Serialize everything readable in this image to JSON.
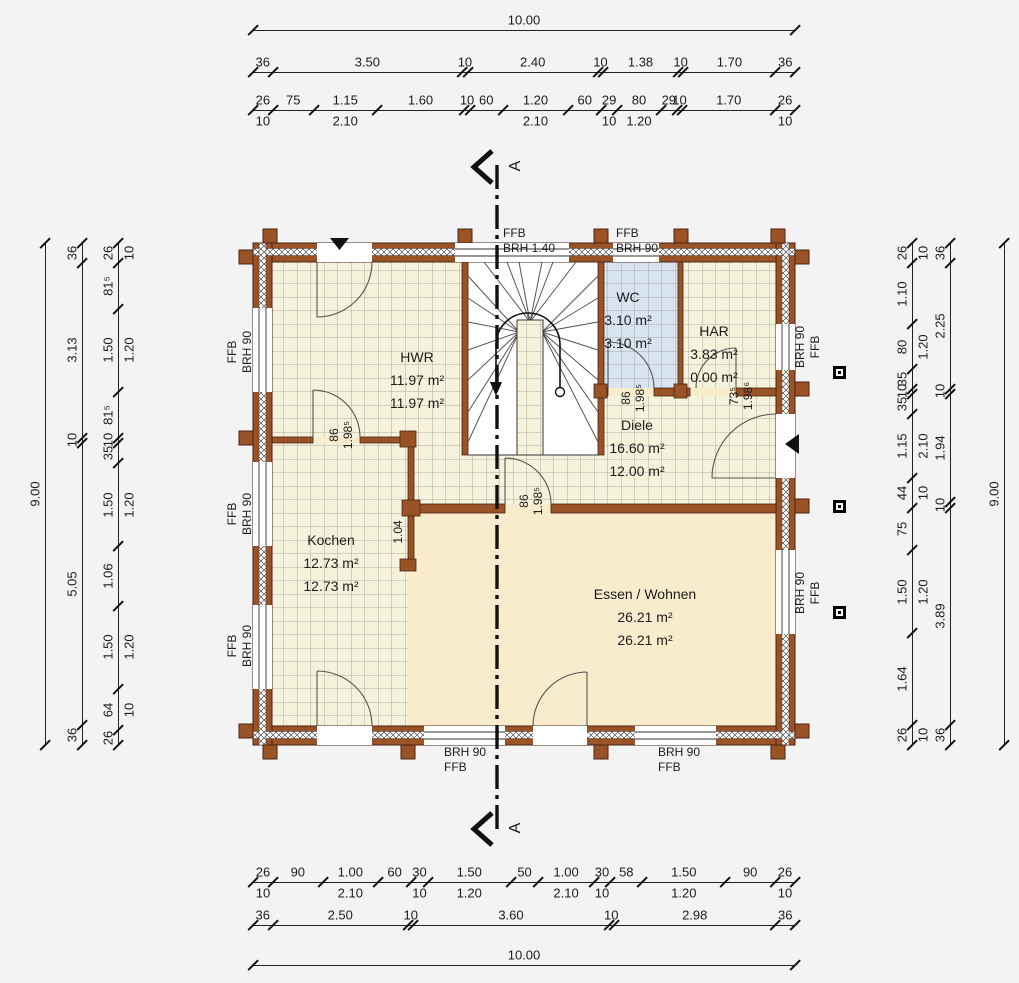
{
  "plan": {
    "section_marker": "A",
    "rooms": [
      {
        "name": "HWR",
        "area1": "11.97 m²",
        "area2": "11.97 m²"
      },
      {
        "name": "WC",
        "area1": "3.10 m²",
        "area2": "3.10 m²"
      },
      {
        "name": "HAR",
        "area1": "3.83 m²",
        "area2": "0.00 m²"
      },
      {
        "name": "Diele",
        "area1": "16.60 m²",
        "area2": "12.00 m²"
      },
      {
        "name": "Kochen",
        "area1": "12.73 m²",
        "area2": "12.73 m²"
      },
      {
        "name": "Essen / Wohnen",
        "area1": "26.21 m²",
        "area2": "26.21 m²"
      }
    ],
    "door_labels": [
      {
        "width": "86",
        "height": "1.98⁵"
      },
      {
        "width": "86",
        "height": "1.98⁵"
      },
      {
        "width": "73⁵",
        "height": "1.98⁶"
      },
      {
        "width": "86",
        "height": "1.98⁵"
      }
    ],
    "wall_label": "1.04",
    "window_labels": {
      "top": [
        {
          "l1": "FFB",
          "l2": "BRH 1.40"
        },
        {
          "l1": "FFB",
          "l2": "BRH 90"
        }
      ],
      "left": [
        {
          "l1": "FFB",
          "l2": "BRH 90"
        },
        {
          "l1": "FFB",
          "l2": "BRH 90"
        },
        {
          "l1": "FFB",
          "l2": "BRH 90"
        }
      ],
      "right": [
        {
          "l1": "BRH 90",
          "l2": "FFB"
        },
        {
          "l1": "BRH 90",
          "l2": "FFB"
        }
      ],
      "bottom": [
        {
          "l1": "BRH 90",
          "l2": "FFB"
        },
        {
          "l1": "BRH 90",
          "l2": "FFB"
        }
      ]
    },
    "colors": {
      "wall_brown": "#9A5227",
      "tile_floor": "#F5F3DC",
      "wood_floor": "#F9ECCD",
      "wc_floor": "#D8E4F2"
    }
  },
  "dimensions": {
    "top": [
      {
        "segments": [
          {
            "label": "10.00",
            "m": 10
          }
        ]
      },
      {
        "segments": [
          {
            "label": "36",
            "m": 0.36
          },
          {
            "label": "3.50",
            "m": 3.5
          },
          {
            "label": "10",
            "m": 0.1
          },
          {
            "label": "2.40",
            "m": 2.4
          },
          {
            "label": "10",
            "m": 0.1
          },
          {
            "label": "1.38",
            "m": 1.38
          },
          {
            "label": "10",
            "m": 0.1
          },
          {
            "label": "1.70",
            "m": 1.7
          },
          {
            "label": "36",
            "m": 0.36
          }
        ]
      },
      {
        "segments": [
          {
            "label": "26",
            "m": 0.36,
            "sub": "10"
          },
          {
            "label": "75",
            "m": 0.75
          },
          {
            "label": "1.15",
            "m": 1.15,
            "sub": "2.10"
          },
          {
            "label": "1.60",
            "m": 1.6
          },
          {
            "label": "10",
            "m": 0.1
          },
          {
            "label": "60",
            "m": 0.6
          },
          {
            "label": "1.20",
            "m": 1.2,
            "sub": "2.10"
          },
          {
            "label": "60",
            "m": 0.6
          },
          {
            "label": "29",
            "m": 0.29,
            "sub": "10"
          },
          {
            "label": "80",
            "m": 0.8,
            "sub": "1.20"
          },
          {
            "label": "29",
            "m": 0.29
          },
          {
            "label": "10",
            "m": 0.1
          },
          {
            "label": "1.70",
            "m": 1.7
          },
          {
            "label": "26",
            "m": 0.36,
            "sub": "10"
          }
        ]
      }
    ],
    "bottom": [
      {
        "segments": [
          {
            "label": "26",
            "m": 0.36,
            "sub": "10"
          },
          {
            "label": "90",
            "m": 0.9
          },
          {
            "label": "1.00",
            "m": 1.0,
            "sub": "2.10"
          },
          {
            "label": "60",
            "m": 0.6
          },
          {
            "label": "30",
            "m": 0.3,
            "sub": "10"
          },
          {
            "label": "1.50",
            "m": 1.5,
            "sub": "1.20"
          },
          {
            "label": "50",
            "m": 0.5
          },
          {
            "label": "1.00",
            "m": 1.0,
            "sub": "2.10"
          },
          {
            "label": "30",
            "m": 0.3,
            "sub": "10"
          },
          {
            "label": "58",
            "m": 0.58
          },
          {
            "label": "1.50",
            "m": 1.5,
            "sub": "1.20"
          },
          {
            "label": "90",
            "m": 0.9
          },
          {
            "label": "26",
            "m": 0.36,
            "sub": "10"
          }
        ]
      },
      {
        "segments": [
          {
            "label": "36",
            "m": 0.36
          },
          {
            "label": "2.50",
            "m": 2.5
          },
          {
            "label": "10",
            "m": 0.1
          },
          {
            "label": "3.60",
            "m": 3.6
          },
          {
            "label": "10",
            "m": 0.1
          },
          {
            "label": "2.98",
            "m": 2.98
          },
          {
            "label": "36",
            "m": 0.36
          }
        ]
      },
      {
        "segments": [
          {
            "label": "10.00",
            "m": 10
          }
        ]
      }
    ],
    "left": [
      {
        "segments": [
          {
            "label": "9.00",
            "m": 9
          }
        ]
      },
      {
        "segments": [
          {
            "label": "36",
            "m": 0.36
          },
          {
            "label": "3.13",
            "m": 3.13
          },
          {
            "label": "10",
            "m": 0.1
          },
          {
            "label": "5.05",
            "m": 5.05
          },
          {
            "label": "36",
            "m": 0.36
          }
        ]
      },
      {
        "segments": [
          {
            "label": "26",
            "m": 0.36,
            "sub": "10"
          },
          {
            "label": "81⁵",
            "m": 0.815
          },
          {
            "label": "1.50",
            "m": 1.5,
            "sub": "1.20"
          },
          {
            "label": "81⁵",
            "m": 0.815
          },
          {
            "label": "10",
            "m": 0.1
          },
          {
            "label": "35",
            "m": 0.35
          },
          {
            "label": "1.50",
            "m": 1.5,
            "sub": "1.20"
          },
          {
            "label": "1.06",
            "m": 1.06
          },
          {
            "label": "1.50",
            "m": 1.5,
            "sub": "1.20"
          },
          {
            "label": "64",
            "m": 0.74,
            "sub": "10"
          },
          {
            "label": "26",
            "m": 0.26
          }
        ]
      }
    ],
    "right": [
      {
        "segments": [
          {
            "label": "26",
            "m": 0.36,
            "sub": "10"
          },
          {
            "label": "1.10",
            "m": 1.1
          },
          {
            "label": "80",
            "m": 0.8,
            "sub": "1.20"
          },
          {
            "label": "35",
            "m": 0.35
          },
          {
            "label": "10",
            "m": 0.1
          },
          {
            "label": "35",
            "m": 0.35
          },
          {
            "label": "1.15",
            "m": 1.15,
            "sub": "2.10"
          },
          {
            "label": "44",
            "m": 0.54,
            "sub": "10"
          },
          {
            "label": "75",
            "m": 0.75
          },
          {
            "label": "1.50",
            "m": 1.5,
            "sub": "1.20"
          },
          {
            "label": "1.64",
            "m": 1.64
          },
          {
            "label": "26",
            "m": 0.36,
            "sub": "10"
          }
        ]
      },
      {
        "segments": [
          {
            "label": "36",
            "m": 0.36
          },
          {
            "label": "2.25",
            "m": 2.25
          },
          {
            "label": "10",
            "m": 0.1
          },
          {
            "label": "1.94",
            "m": 1.94
          },
          {
            "label": "10",
            "m": 0.1
          },
          {
            "label": "3.89",
            "m": 3.89
          },
          {
            "label": "36",
            "m": 0.36
          }
        ]
      },
      {
        "segments": [
          {
            "label": "9.00",
            "m": 9
          }
        ]
      }
    ]
  }
}
